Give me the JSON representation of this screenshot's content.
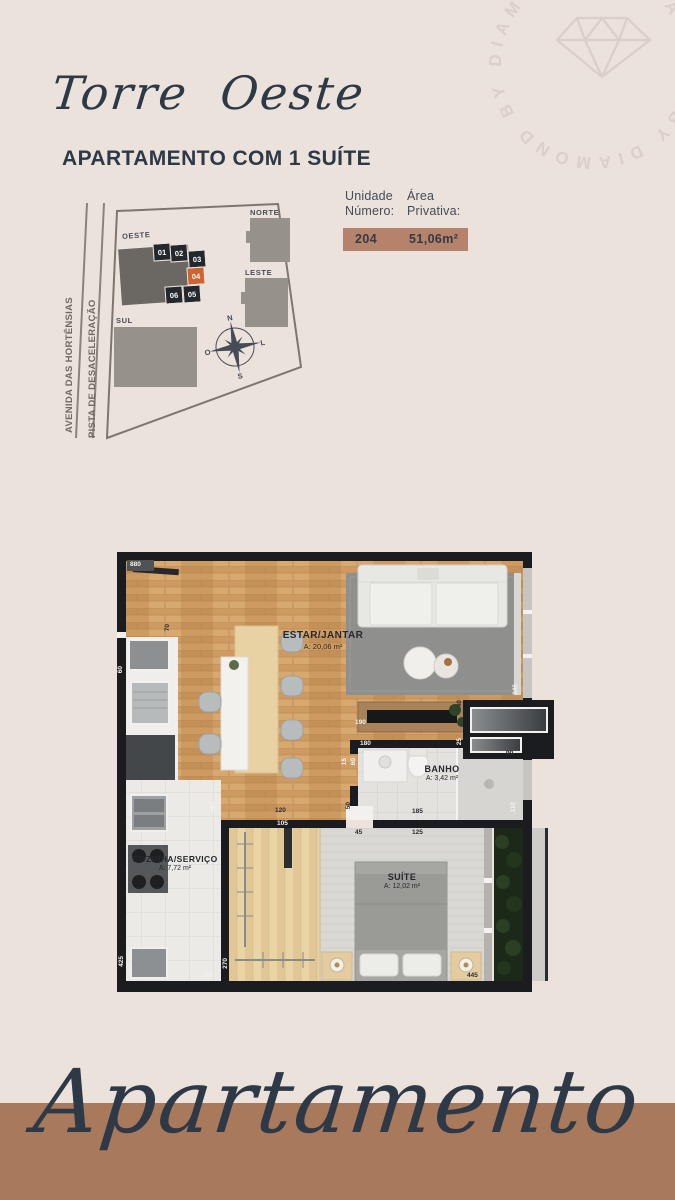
{
  "colors": {
    "background": "#ece2dc",
    "navy": "#2d3947",
    "footer_band": "#a9795b",
    "info_bar": "#b5836b",
    "unit_highlight": "#cf6430",
    "unit_dark": "#23282e",
    "building_gray": "#97918b"
  },
  "header": {
    "tower_title": "Torre Oeste",
    "subtitle": "APARTAMENTO COM 1 SUÍTE"
  },
  "watermark": {
    "circle_text": "BY DIAMOND BY DIAMOND BY DIAMOND",
    "icon": "diamond-gem-outline"
  },
  "site_plan": {
    "streets": [
      "AVENIDA DAS HORTÊNSIAS",
      "PISTA DE DESACELERAÇÃO"
    ],
    "sectors": {
      "oeste": "OESTE",
      "norte": "NORTE",
      "leste": "LESTE",
      "sul": "SUL"
    },
    "units": [
      "01",
      "02",
      "03",
      "04",
      "05",
      "06"
    ],
    "highlighted_unit": "04",
    "compass": {
      "n": "N",
      "l": "L",
      "s": "S",
      "o": "O"
    }
  },
  "unit_info": {
    "col1_line1": "Unidade",
    "col1_line2": "Número:",
    "col2_line1": "Área",
    "col2_line2": "Privativa:",
    "unit_number": "204",
    "private_area": "51,06m²"
  },
  "floor_plan": {
    "rooms": [
      {
        "name": "ESTAR/JANTAR",
        "area": "A: 20,06 m²"
      },
      {
        "name": "BANHO",
        "area": "A: 3,42 m²"
      },
      {
        "name": "COZINHA/SERVIÇO",
        "area": "A: 7,72 m²"
      },
      {
        "name": "SUÍTE",
        "area": "A: 12,02 m²"
      }
    ],
    "dimensions": [
      "880",
      "70",
      "60",
      "75",
      "295",
      "120",
      "105",
      "190",
      "180",
      "40",
      "245",
      "25",
      "90",
      "15",
      "60",
      "50",
      "45",
      "185",
      "125",
      "110",
      "270",
      "160",
      "425",
      "445"
    ]
  },
  "footer": {
    "title": "Apartamento"
  }
}
